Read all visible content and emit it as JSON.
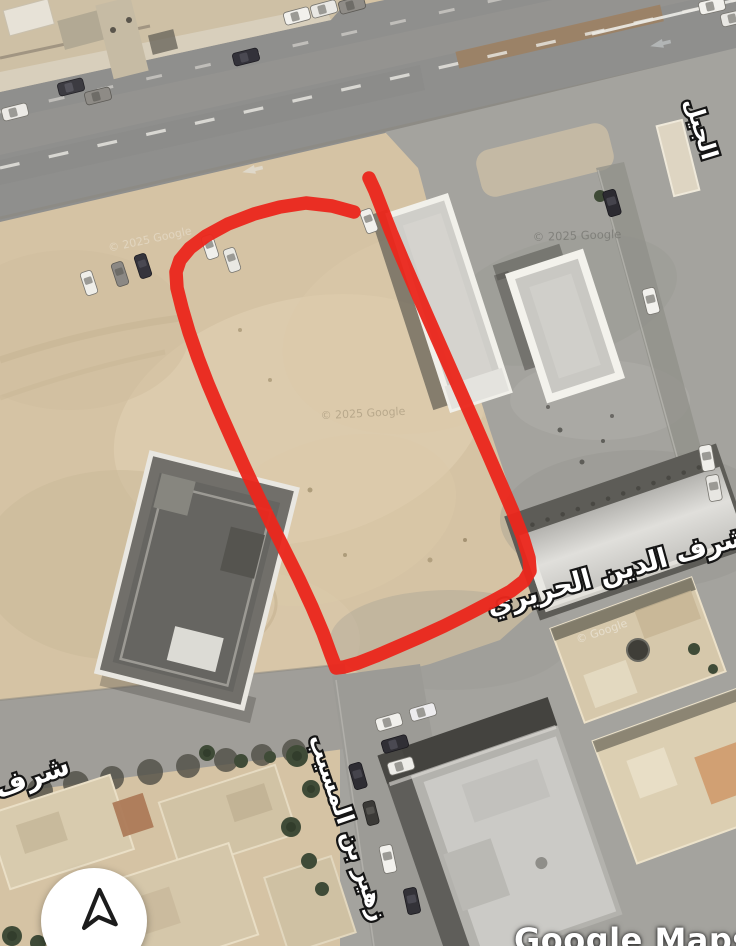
{
  "map": {
    "watermark": "Google Maps",
    "copyright": "© 2025 Google",
    "copyright_short": "© Google",
    "street_labels": [
      {
        "text": "شرف الدين الحريري"
      },
      {
        "text": "زهير بن المسيب"
      },
      {
        "text": "شرف"
      },
      {
        "text": "الجيل"
      }
    ],
    "annotation": {
      "color": "#ea281d"
    },
    "icons": {
      "navigation": "navigation-arrow-icon"
    },
    "colors": {
      "sand": "#d5c3a4",
      "road": "#8f8f8d",
      "pavement": "#a4a39e"
    }
  }
}
